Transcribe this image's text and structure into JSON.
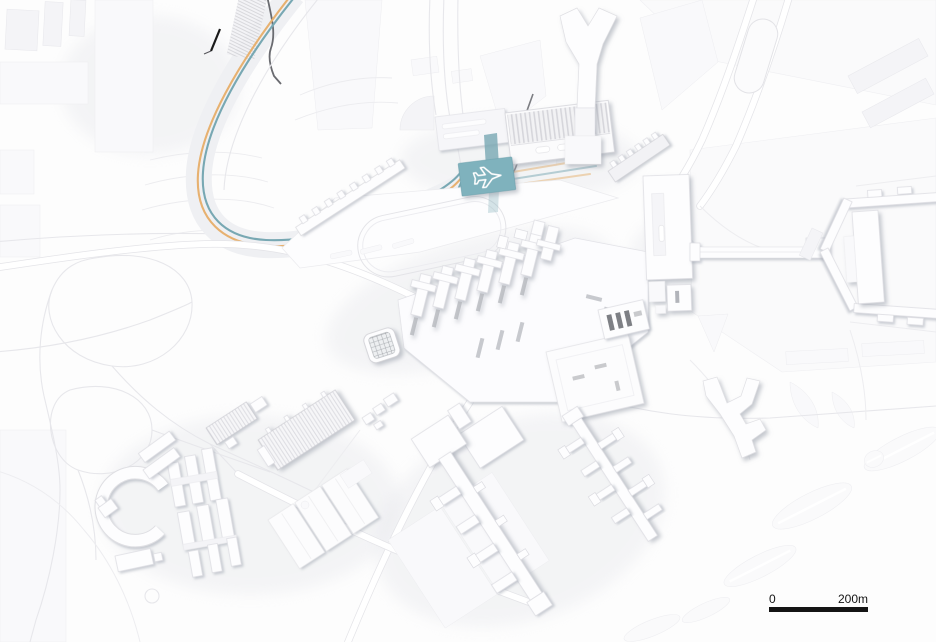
{
  "canvas": {
    "background": "#fdfdfd"
  },
  "rail": {
    "orange": "#e7b170",
    "teal": "#78a8b3"
  },
  "station_marker": {
    "icon": "airplane-icon",
    "fill": "#7fb2bd",
    "plane_color": "#ffffff"
  },
  "scale_bar": {
    "start_label": "0",
    "end_label": "200m",
    "bar_color": "#141414"
  }
}
